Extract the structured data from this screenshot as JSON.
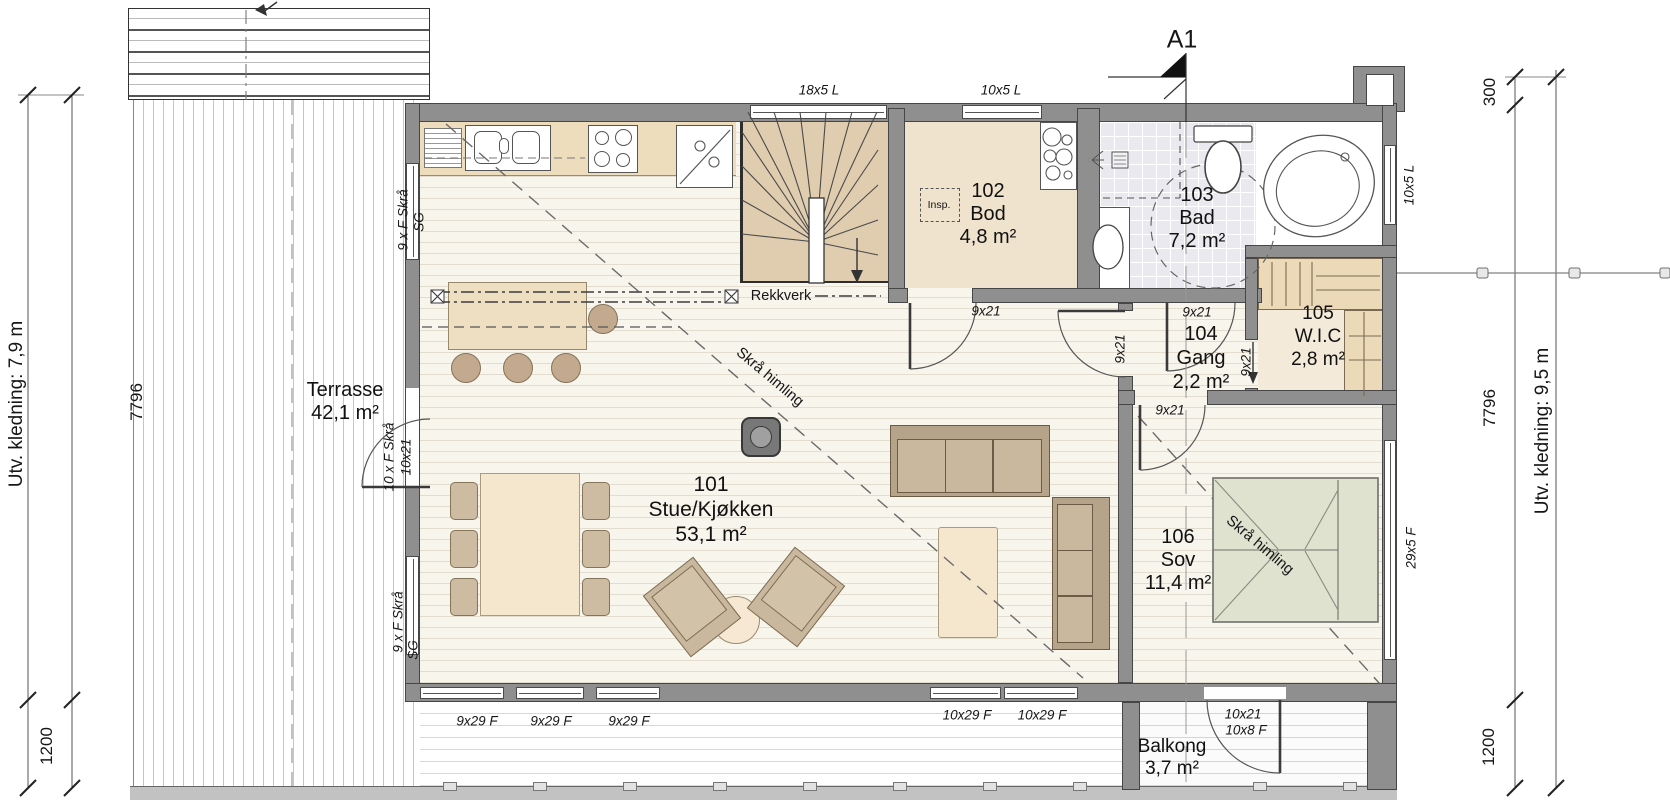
{
  "annotations": {
    "section_label": "A1",
    "rekkverk": "Rekkverk",
    "skra_himling": "Skrå himling",
    "insp": "Insp."
  },
  "rooms": {
    "r101": {
      "no": "101",
      "name": "Stue/Kjøkken",
      "area": "53,1 m²"
    },
    "r102": {
      "no": "102",
      "name": "Bod",
      "area": "4,8 m²"
    },
    "r103": {
      "no": "103",
      "name": "Bad",
      "area": "7,2 m²"
    },
    "r104": {
      "no": "104",
      "name": "Gang",
      "area": "2,2 m²"
    },
    "r105": {
      "no": "105",
      "name": "W.I.C",
      "area": "2,8 m²"
    },
    "r106": {
      "no": "106",
      "name": "Sov",
      "area": "11,4 m²"
    }
  },
  "outdoor": {
    "terrasse": {
      "name": "Terrasse",
      "area": "42,1 m²"
    },
    "balkong": {
      "name": "Balkong",
      "area": "3,7 m²"
    }
  },
  "openings": {
    "window_18x5": "18x5 L",
    "window_10x5": "10x5 L",
    "door_9x21": "9x21",
    "window_9x29": "9x29 F",
    "window_10x29": "10x29 F",
    "window_29x5": "29x5 F",
    "balcony_door_size": "10x21",
    "balcony_window": "10x8 F",
    "terrace_door_type": "10 x F Skrå",
    "terrace_door_size": "10x21",
    "left_window_type": "9 x F Skrå",
    "left_window_glass": "SG"
  },
  "dimensions": {
    "left_total": "7796",
    "left_offset": "1200",
    "left_cladding": "Utv. kledning: 7,9 m",
    "right_roof": "300",
    "right_total": "7796",
    "right_offset": "1200",
    "right_cladding": "Utv. kledning: 9,5 m"
  },
  "colors": {
    "wall_gray": "#8f8f8f",
    "wood_floor": "#f7f5ec",
    "counter_beige": "#eeddbd",
    "furniture_tan": "#c9b89e",
    "bed_green": "#dee2cf",
    "bath_tile": "#e9e9ef",
    "stair_beige": "#e0cdb0"
  }
}
